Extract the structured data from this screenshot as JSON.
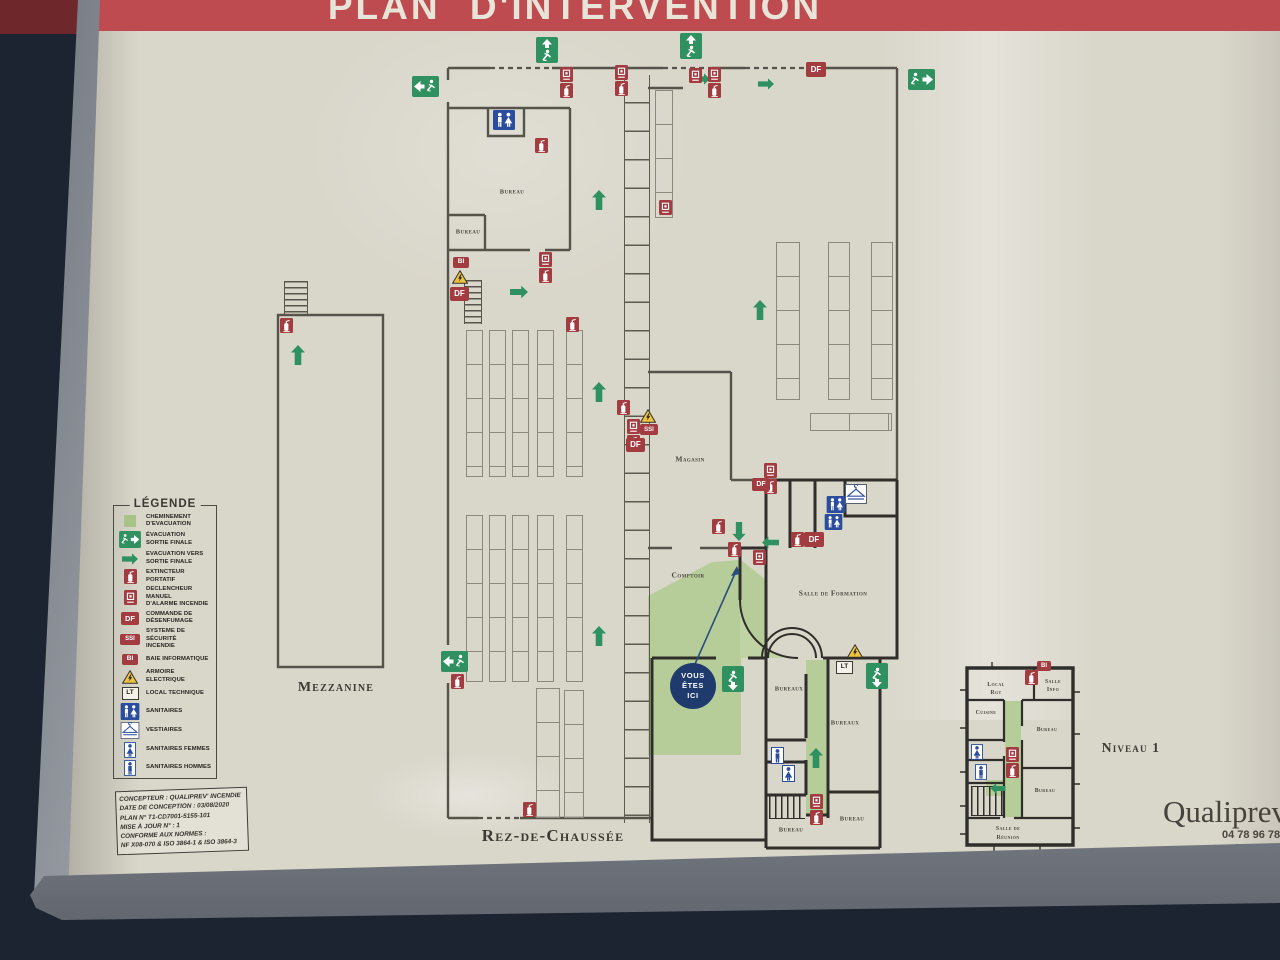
{
  "banner": {
    "title": "PLAN D'INTERVENTION"
  },
  "legend": {
    "title": "LÉGENDE",
    "items": [
      {
        "icon": "evacuation-path-swatch",
        "label": "CHEMINEMENT\nD'EVACUATION"
      },
      {
        "icon": "exit-sign-icon",
        "label": "ÉVACUATION\nSORTIE FINALE"
      },
      {
        "icon": "green-arrow-icon",
        "label": "EVACUATION VERS\nSORTIE FINALE"
      },
      {
        "icon": "extinguisher-icon",
        "label": "EXTINCTEUR\nPORTATIF"
      },
      {
        "icon": "fire-alarm-icon",
        "label": "DECLENCHEUR MANUEL\nD'ALARME INCENDIE"
      },
      {
        "icon": "df-icon",
        "label": "COMMANDE DE\nDÉSENFUMAGE"
      },
      {
        "icon": "ssi-icon",
        "label": "SYSTEME DE SÉCURITÉ\nINCENDIE"
      },
      {
        "icon": "bi-icon",
        "label": "BAIE INFORMATIQUE"
      },
      {
        "icon": "electric-warning-icon",
        "label": "ARMOIRE ELECTRIQUE"
      },
      {
        "icon": "lt-icon",
        "label": "LOCAL TECHNIQUE"
      },
      {
        "icon": "restroom-icon",
        "label": "SANITAIRES"
      },
      {
        "icon": "cloakroom-icon",
        "label": "VESTIAIRES"
      },
      {
        "icon": "restroom-women-icon",
        "label": "SANITAIRES FEMMES"
      },
      {
        "icon": "restroom-men-icon",
        "label": "SANITAIRES HOMMES"
      }
    ]
  },
  "symbols": {
    "df": "DF",
    "ssi": "SSI",
    "bi": "BI",
    "lt": "LT"
  },
  "info_box": {
    "lines": [
      "CONCEPTEUR : QUALIPREV' INCENDIE",
      "DATE DE CONCEPTION : 03/08/2020",
      "PLAN N° T1-CD7001-5155-101",
      "MISE À JOUR N° : 1",
      "CONFORME AUX NORMES :",
      "NF X08-070 & ISO 3864-1 & ISO 3864-3"
    ]
  },
  "plan": {
    "floor_label": "Rez-de-Chaussée",
    "mezzanine_label": "Mezzanine",
    "rooms": {
      "bureau_a": "Bureau",
      "bureau_b": "Bureau",
      "magasin": "Magasin",
      "comptoir": "Comptoir",
      "salle_formation": "Salle de Formation",
      "bureaux_a": "Bureaux",
      "bureaux_b": "Bureaux",
      "bureau_c": "Bureau",
      "bureau_d": "Bureau"
    },
    "you_are_here": {
      "l1": "VOUS",
      "l2": "ÊTES",
      "l3": "ICI"
    }
  },
  "niveau1": {
    "label": "Niveau 1",
    "rooms": {
      "local_rgt_1": "Local",
      "local_rgt_2": "Rgt",
      "salle_info_1": "Salle",
      "salle_info_2": "Info",
      "cuisine": "Cuisine",
      "bureau_a": "Bureau",
      "bureau_b": "Bureau",
      "reunion_1": "Salle de",
      "reunion_2": "Réunion"
    }
  },
  "footer": {
    "brand": "Qualiprev",
    "phone": "04 78 96 78 1",
    "email": "contact@qualip"
  },
  "colors": {
    "banner_red": "#bd4b4f",
    "evac_green": "#b6cd99",
    "sign_green": "#2f9160",
    "icon_red": "#a23c41",
    "sanitary_blue": "#2b4d9e",
    "board": "#d9d6ca"
  }
}
